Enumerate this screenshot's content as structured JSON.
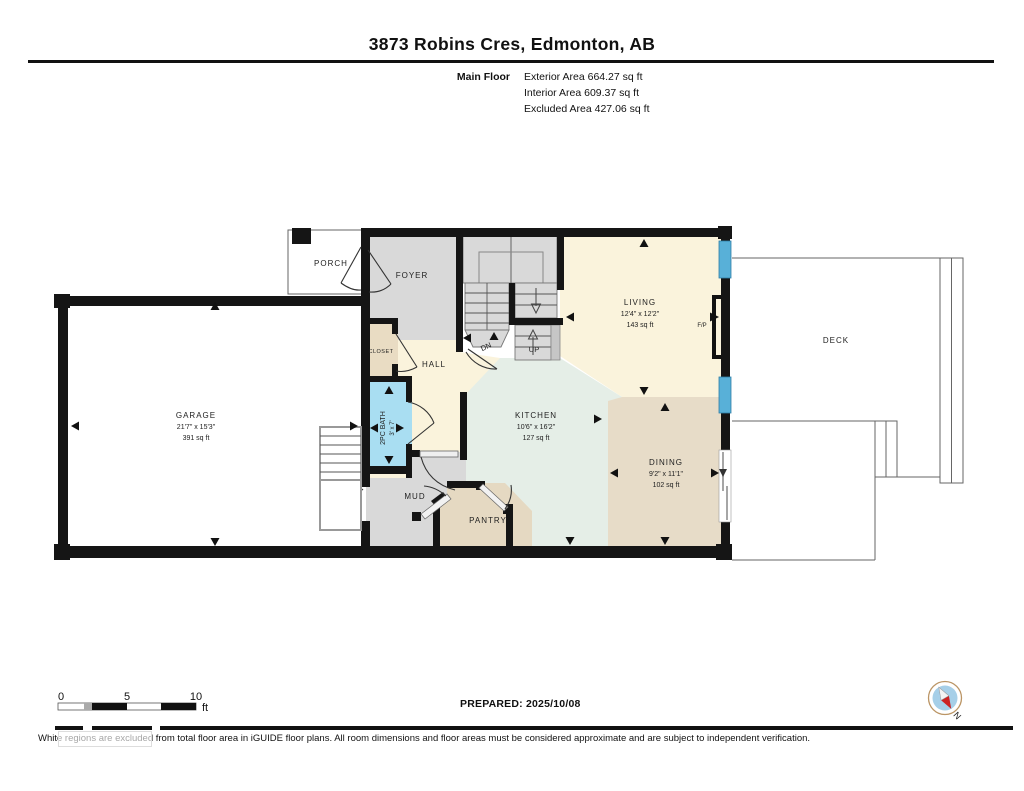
{
  "header": {
    "title": "3873 Robins Cres, Edmonton, AB",
    "floor_label": "Main Floor",
    "stat_exterior": "Exterior Area 664.27 sq ft",
    "stat_interior": "Interior Area 609.37 sq ft",
    "stat_excluded": "Excluded Area 427.06 sq ft"
  },
  "rooms": {
    "porch": {
      "name": "PORCH"
    },
    "foyer": {
      "name": "FOYER"
    },
    "garage": {
      "name": "GARAGE",
      "dims": "21'7\" x 15'3\"",
      "area": "391 sq ft"
    },
    "closet": {
      "name": "CLOSET"
    },
    "hall": {
      "name": "HALL"
    },
    "bath": {
      "name": "2PC BATH",
      "dims": "3' x 7'"
    },
    "mud": {
      "name": "MUD"
    },
    "pantry": {
      "name": "PANTRY"
    },
    "kitchen": {
      "name": "KITCHEN",
      "dims": "10'6\" x 16'2\"",
      "area": "127 sq ft"
    },
    "living": {
      "name": "LIVING",
      "dims": "12'4\" x 12'2\"",
      "area": "143 sq ft"
    },
    "dining": {
      "name": "DINING",
      "dims": "9'2\" x 11'1\"",
      "area": "102 sq ft"
    },
    "deck": {
      "name": "DECK"
    },
    "fireplace": {
      "label": "F/P"
    }
  },
  "stairs": {
    "down_label": "DN",
    "up_label": "UP"
  },
  "scale_bar": {
    "tick_0": "0",
    "tick_5": "5",
    "tick_10": "10",
    "unit": "ft"
  },
  "footer": {
    "prepared": "PREPARED: 2025/10/08",
    "disclaimer": "White regions are excluded from total floor area in iGUIDE floor plans. All room dimensions and floor areas must be considered approximate and are subject to independent verification."
  },
  "compass": {
    "north_label": "N"
  },
  "colors": {
    "wall": "#151515",
    "cream": "#faf3dc",
    "mint": "#e5eee7",
    "tan": "#e7dcc6",
    "gray": "#d9d9d9",
    "bath_blue": "#a9def2",
    "window_blue": "#58b0d8"
  }
}
